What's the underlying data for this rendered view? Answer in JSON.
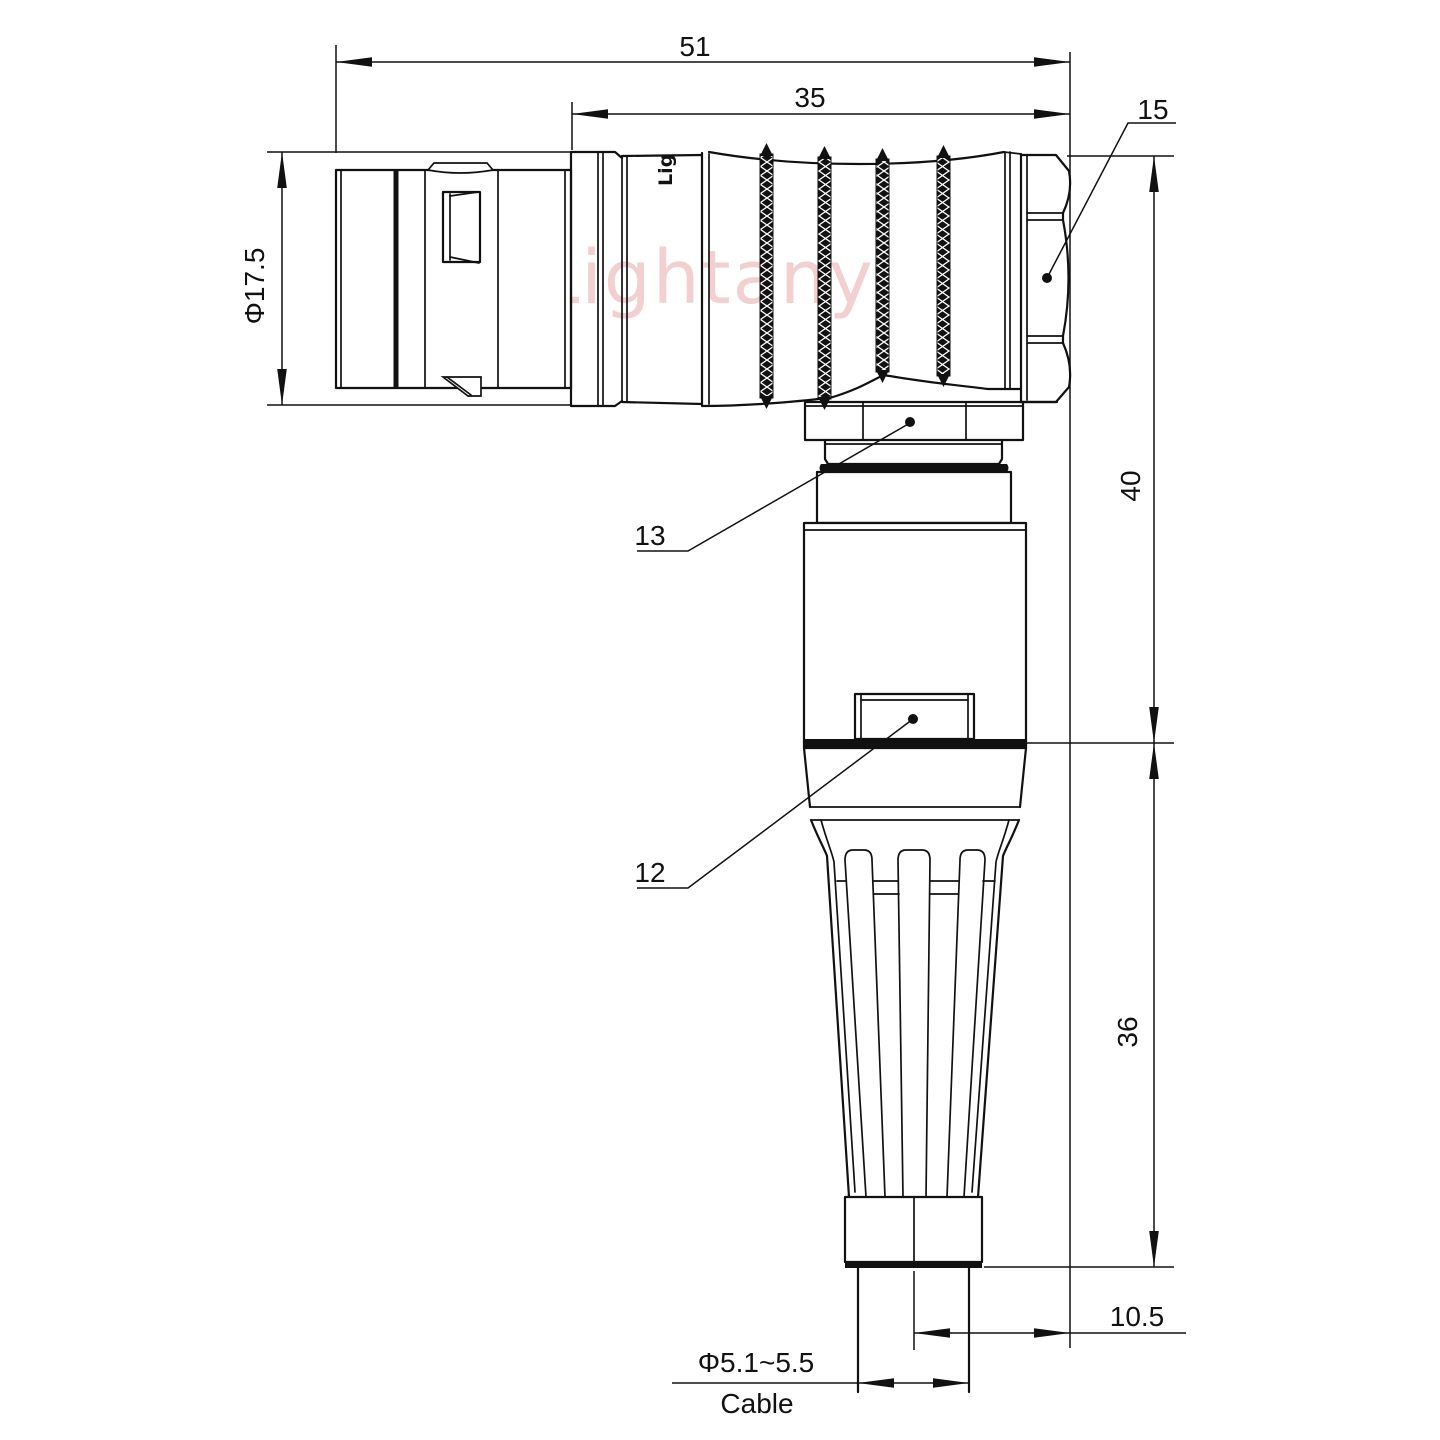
{
  "page": {
    "background": "#ffffff"
  },
  "drawing": {
    "type": "technical-drawing",
    "subject": "right-angle circular push-pull connector, dimensioned side view",
    "watermark": "Lightany",
    "engraving_fragment": "Lig",
    "line_color": "#111111",
    "watermark_color": "#f3cfcf",
    "dimensions": {
      "overall_length": "51",
      "rear_length": "35",
      "hex_nut_ref": "15",
      "front_diameter": "Φ17.5",
      "height_upper": "40",
      "height_lower": "36",
      "axis_offset": "10.5",
      "cable_diameter": "Φ5.1~5.5",
      "cable_label": "Cable",
      "ref_13": "13",
      "ref_12": "12"
    }
  }
}
